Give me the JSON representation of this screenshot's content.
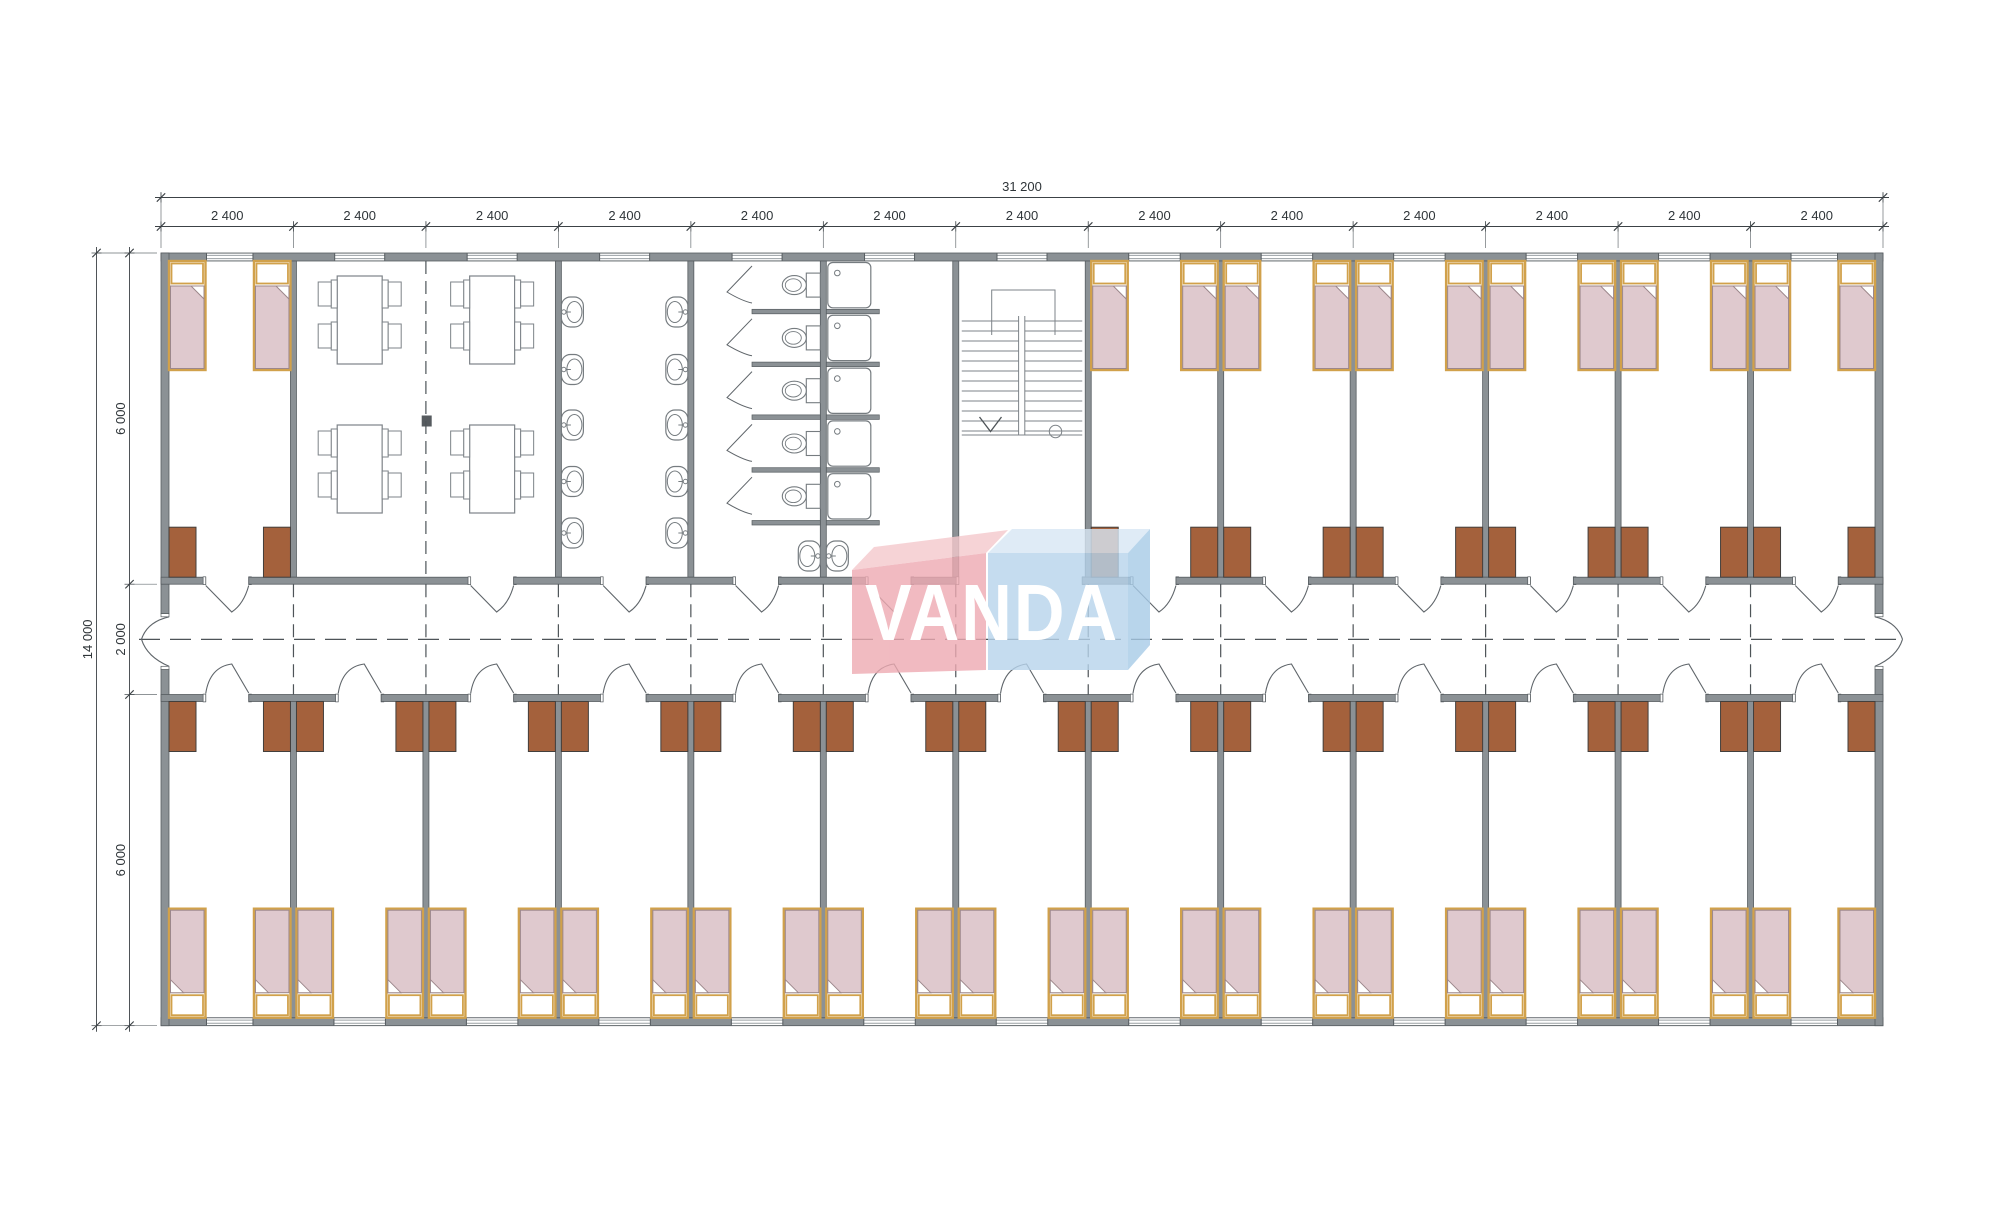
{
  "page": {
    "background": "#ffffff",
    "type": "architectural-floor-plan",
    "view": "dormitory module building - floor plan"
  },
  "logo": {
    "text": "VANDA",
    "red": "#eeaab2",
    "red_light": "#f5c9cd",
    "blue": "#b7d4ec",
    "blue_light": "#d8e7f5",
    "blue_dark": "#a7cbe7",
    "text_color": "#ffffff"
  },
  "dimensions": {
    "overall_width": "31 200",
    "module_width": "2 400",
    "module_count": 13,
    "overall_depth": "14 000",
    "top_bay_depth": "6 000",
    "corridor_depth": "2 000",
    "bottom_bay_depth": "6 000"
  },
  "plan": {
    "top_row": [
      {
        "module": "1",
        "type": "bedroom",
        "beds": 2,
        "wardrobes": 2
      },
      {
        "module": "2-3",
        "type": "dining-room",
        "tables": 4,
        "chairs_per_table": 4
      },
      {
        "module": "4",
        "type": "washroom",
        "wash_basins": 10
      },
      {
        "module": "5",
        "type": "toilet-room",
        "toilet_stalls": 5,
        "wash_basins": 2
      },
      {
        "module": "6",
        "type": "shower-room",
        "shower_cubicles": 5
      },
      {
        "module": "7",
        "type": "stairwell",
        "stairs": 1
      },
      {
        "module": "8-13",
        "type": "bedrooms",
        "rooms": 6,
        "beds_per_room": 2,
        "wardrobes_per_room": 2
      }
    ],
    "bottom_row": [
      {
        "module": "1-13",
        "type": "bedrooms",
        "rooms": 13,
        "beds_per_room": 2,
        "wardrobes_per_room": 2
      }
    ],
    "corridor": {
      "position": "center",
      "end_doors": 2,
      "module_joint_axes": 12
    }
  },
  "colors": {
    "wall": "#8b9195",
    "wall_edge": "#565c60",
    "line": "#7d8388",
    "dash": "#4e5458",
    "bed_frame": "#d1a14b",
    "bed_blanket": "#dfc9ce",
    "bed_blanket_edge": "#9c878b",
    "wardrobe": "#a4613c",
    "wardrobe_edge": "#433f3c",
    "door": "#5f656a",
    "dim_line": "#3c4246",
    "dim_text": "#2f3539",
    "fixture": "#767c80"
  }
}
